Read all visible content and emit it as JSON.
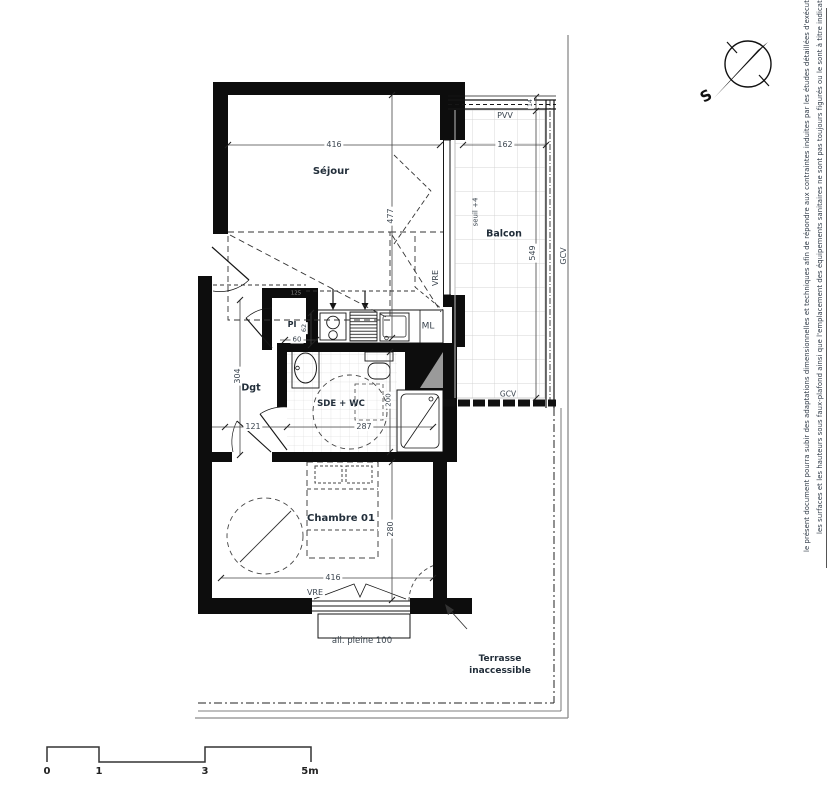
{
  "disclaimer": {
    "line1": "le présent document pourra subir des adaptations dimensionnelles et techniques afin de répondre aux contraintes induites par les études détaillées d'exécution",
    "line2": "les surfaces et les hauteurs sous faux-plafond ainsi que l'emplacement des équipements sanitaires ne sont pas toujours figurés ou le sont à titre indicatif."
  },
  "compass": {
    "south_label": "S"
  },
  "rooms": {
    "sejour": "Séjour",
    "balcon": "Balcon",
    "degagement": "Dgt",
    "sde_wc": "SDE + WC",
    "chambre": "Chambre 01",
    "terrasse_line1": "Terrasse",
    "terrasse_line2": "inaccessible"
  },
  "labels": {
    "pvv": "PVV",
    "vre_sejour": "VRE",
    "vre_chambre": "VRE",
    "gcv_right": "GCV",
    "gcv_balcony": "GCV",
    "ml": "ML",
    "pi": "PI",
    "seuil": "seuil +4",
    "allege": "all. pleine 100"
  },
  "dimensions": {
    "sejour_width": "416",
    "sejour_depth": "477",
    "balcon_width": "162",
    "balcon_rail": "14",
    "balcon_depth": "549",
    "degagement_depth": "304",
    "degagement_width": "121",
    "placard_width": "60",
    "placard_depth": "62",
    "placard_niche": "125",
    "sde_width": "287",
    "sde_depth": "200",
    "chambre_width": "416",
    "chambre_depth": "280"
  },
  "scale_bar": {
    "t0": "0",
    "t1": "1",
    "t3": "3",
    "t5": "5m"
  }
}
